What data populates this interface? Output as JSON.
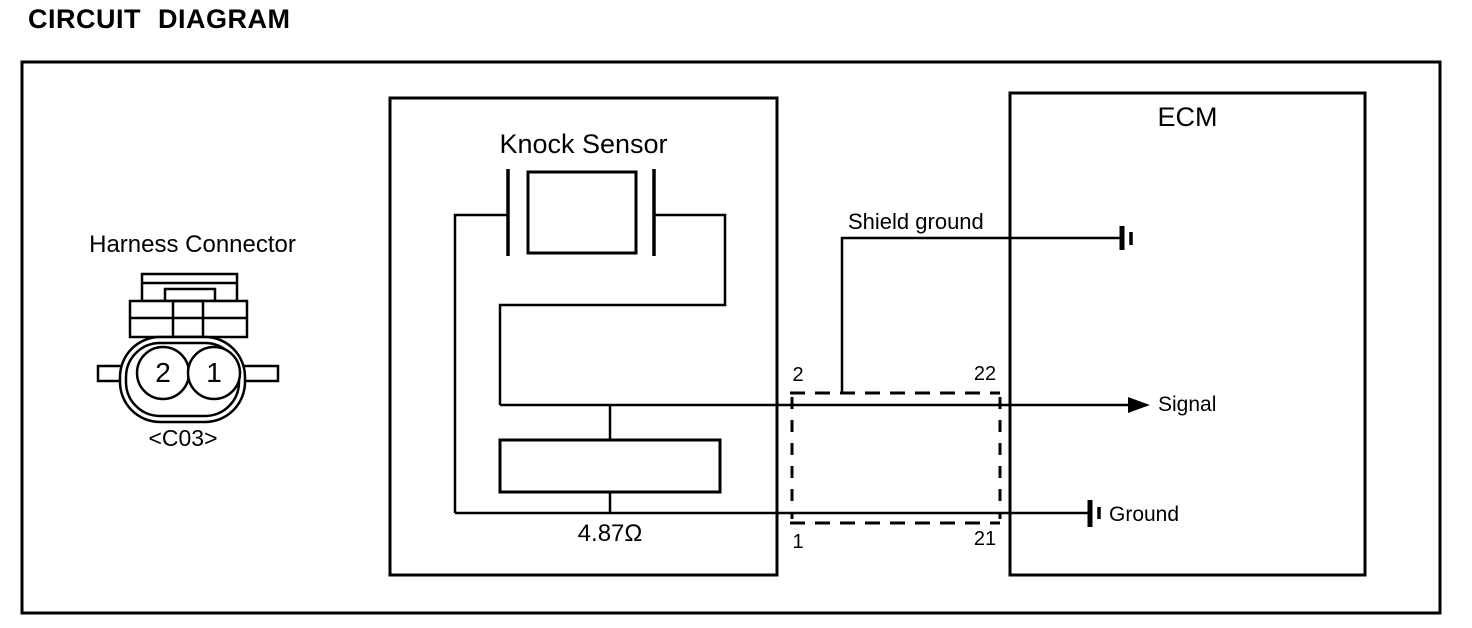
{
  "page_title": "CIRCUIT DIAGRAM",
  "harness_connector": {
    "label": "Harness Connector",
    "code": "<C03>",
    "pin_left": "2",
    "pin_right": "1"
  },
  "knock_sensor": {
    "label": "Knock Sensor",
    "resistance": "4.87Ω"
  },
  "ecm": {
    "label": "ECM"
  },
  "inline_connector_pins": {
    "top_left": "2",
    "top_right": "22",
    "bottom_left": "1",
    "bottom_right": "21"
  },
  "wires": {
    "shield_ground": "Shield ground",
    "signal": "Signal",
    "ground": "Ground"
  },
  "colors": {
    "line": "#000000",
    "background": "#ffffff"
  }
}
